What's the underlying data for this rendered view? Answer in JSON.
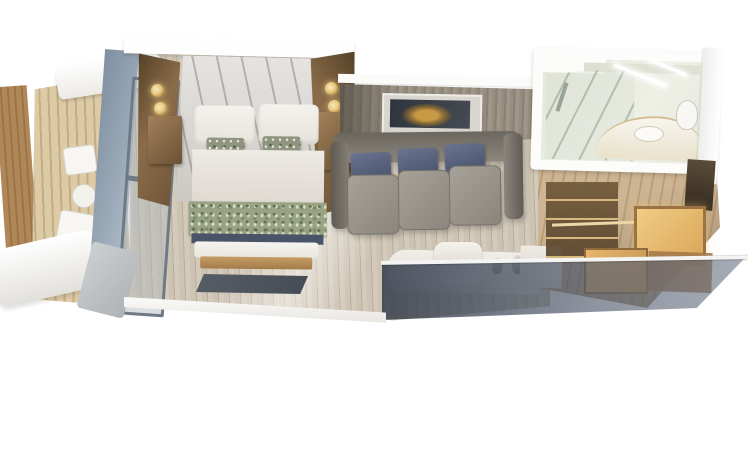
{
  "meta": {
    "type": "3d-cutaway-floorplan-render",
    "subject": "cruise-ship-veranda-stateroom",
    "visible_text": "none"
  },
  "palette": {
    "wood-deck": "#ddcba6",
    "wood-deck-line": "#c3ad85",
    "wood-divider": "#b08758",
    "glass-blue": "#9aa9b8",
    "glass-blue-dark": "#7f90a1",
    "wood-mid": "#8a6c49",
    "wood-dark": "#6e5438",
    "sconce-gold": "#e8c87f",
    "headboard": "#cbc8c3",
    "duvet": "#eeeae4",
    "accent-pillow": "#8e9480",
    "runner-green": "#99a384",
    "navy": "#4a5468",
    "bench-tan": "#c59c63",
    "carpet": "#cdc3b2",
    "carpet-line": "#b9ae9c",
    "rug-dark": "#454c55",
    "wall-wood": "#968d7f",
    "art-bg": "#2f353c",
    "art-gold": "#c89a45",
    "sofa-gray": "#8b877e",
    "sofa-pillow": "#49526a",
    "desk-white": "#f1eee8",
    "bath-interior": "#e4e7db",
    "vanity-tan": "#d3bd90",
    "hall-wood": "#cdb493",
    "hall-wood-line": "#b99e79",
    "closet-amber": "#f2cc85",
    "closet-wood": "#9b7342"
  },
  "scene": {
    "balcony": {
      "items": [
        "privacy-divider",
        "teak-deck",
        "white-canopy",
        "lounge-chair",
        "side-table",
        "lounge-chair",
        "front-railing",
        "sliding-glass-door"
      ]
    },
    "bedroom": {
      "items": [
        "queen-bed",
        "white-pillows",
        "patterned-accent-pillows",
        "floral-bed-runner",
        "foot-bench",
        "nightstand-left",
        "nightstand-right",
        "wall-sconces",
        "padded-headboard",
        "dark-area-rug",
        "striped-carpet"
      ]
    },
    "living_area": {
      "items": [
        "three-seat-sofa",
        "navy-throw-pillows",
        "abstract-framed-art",
        "wood-panel-wall",
        "desk-vanity",
        "desk-chair",
        "sink-faucets",
        "side-counter"
      ]
    },
    "bathroom": {
      "items": [
        "glass-shower",
        "curved-vanity",
        "sink",
        "toilet",
        "ceiling-lights",
        "shelf"
      ]
    },
    "entry": {
      "items": [
        "wood-plank-hallway",
        "open-wardrobe-shelves",
        "hanging-rail",
        "backlit-closet-panels",
        "entrance-door"
      ]
    },
    "cutaway": {
      "items": [
        "transparent-front-wall",
        "white-wall-cross-section"
      ]
    }
  }
}
